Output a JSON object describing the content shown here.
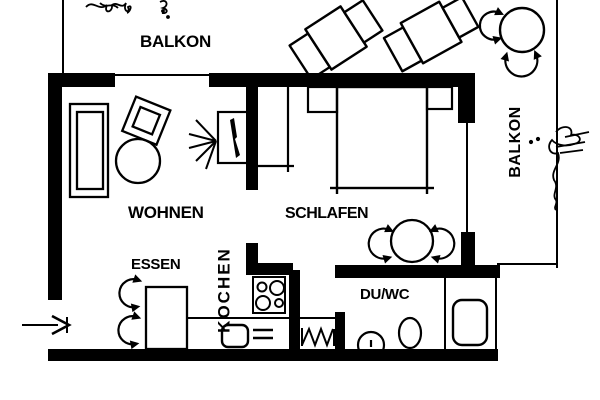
{
  "colors": {
    "ink": "#000000",
    "paper": "#ffffff"
  },
  "plan": {
    "balcony_top_label": "BALKON",
    "balcony_right_label": "BALKON",
    "living_label": "WOHNEN",
    "bedroom_label": "SCHLAFEN",
    "dining_label": "ESSEN",
    "kitchen_label": "KOCHEN",
    "bath_label": "DU/WC"
  }
}
